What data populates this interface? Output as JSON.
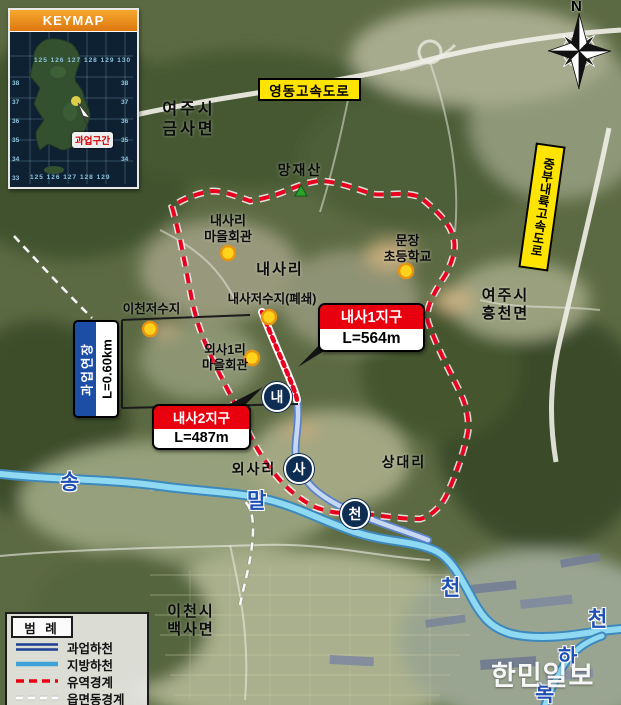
{
  "keymap": {
    "title": "KEYMAP",
    "marker_label": "과업구간",
    "coords_top": "125 126 127 128 129 130",
    "coords_left": "38\n37\n36\n35\n34\n33",
    "coords_right": "38\n37\n36\n35\n34",
    "coords_bottom": "125  126  127  128  129"
  },
  "compass": {
    "north_label": "N"
  },
  "highways": {
    "yeongdong": "영동고속도로",
    "jungbu_naeryuk": "중부내륙고속도로"
  },
  "callouts": {
    "naesa1": {
      "title": "내사1지구",
      "length": "L=564m"
    },
    "naesa2": {
      "title": "내사2지구",
      "length": "L=487m"
    },
    "extension": {
      "title": "과업연장",
      "length": "L=0.60km"
    }
  },
  "places": {
    "yeoju_geumsa": "여주시\n금사면",
    "mangjaesan": "망재산",
    "naesari_hall": "내사리\n마을회관",
    "naesari": "내사리",
    "munjang_school": "문장\n초등학교",
    "naesa_reservoir": "내사저수지(폐쇄)",
    "icheon_reservoir": "이천저수지",
    "oesa1ri_hall": "외사1리\n마을회관",
    "yeoju_heungcheon": "여주시\n흥천면",
    "sangdaeri": "상대리",
    "oesari": "외사리",
    "icheon_baeksa": "이천시\n백사면"
  },
  "rivers": {
    "song": "송",
    "mal": "말",
    "cheon_west": "천",
    "cheon_east": "천",
    "ha": "하",
    "bok": "복",
    "circle_nae": "내",
    "circle_sa": "사",
    "circle_cheon": "천"
  },
  "legend": {
    "title": "범 례",
    "items": [
      {
        "symbol": "double-navy-line",
        "label": "과업하천",
        "color": "#1c3f94"
      },
      {
        "symbol": "single-blue-line",
        "label": "지방하천",
        "color": "#3fa3d9"
      },
      {
        "symbol": "red-dashed-line",
        "label": "유역경계",
        "color": "#e60012"
      },
      {
        "symbol": "white-dashed-line",
        "label": "읍면동경계",
        "color": "#ffffff"
      }
    ]
  },
  "watermark": "한민일보",
  "colors": {
    "highway_label_bg": "#ffe400",
    "district_callout_red": "#e8000f",
    "extension_box_blue": "#1c4ea6",
    "watershed_boundary_red": "#e8001e",
    "local_river_blue": "#8fd9f2",
    "project_river_navy": "#5a82c8",
    "poi_marker_yellow": "#ffd21c",
    "keymap_header_orange": "#e8891c"
  }
}
